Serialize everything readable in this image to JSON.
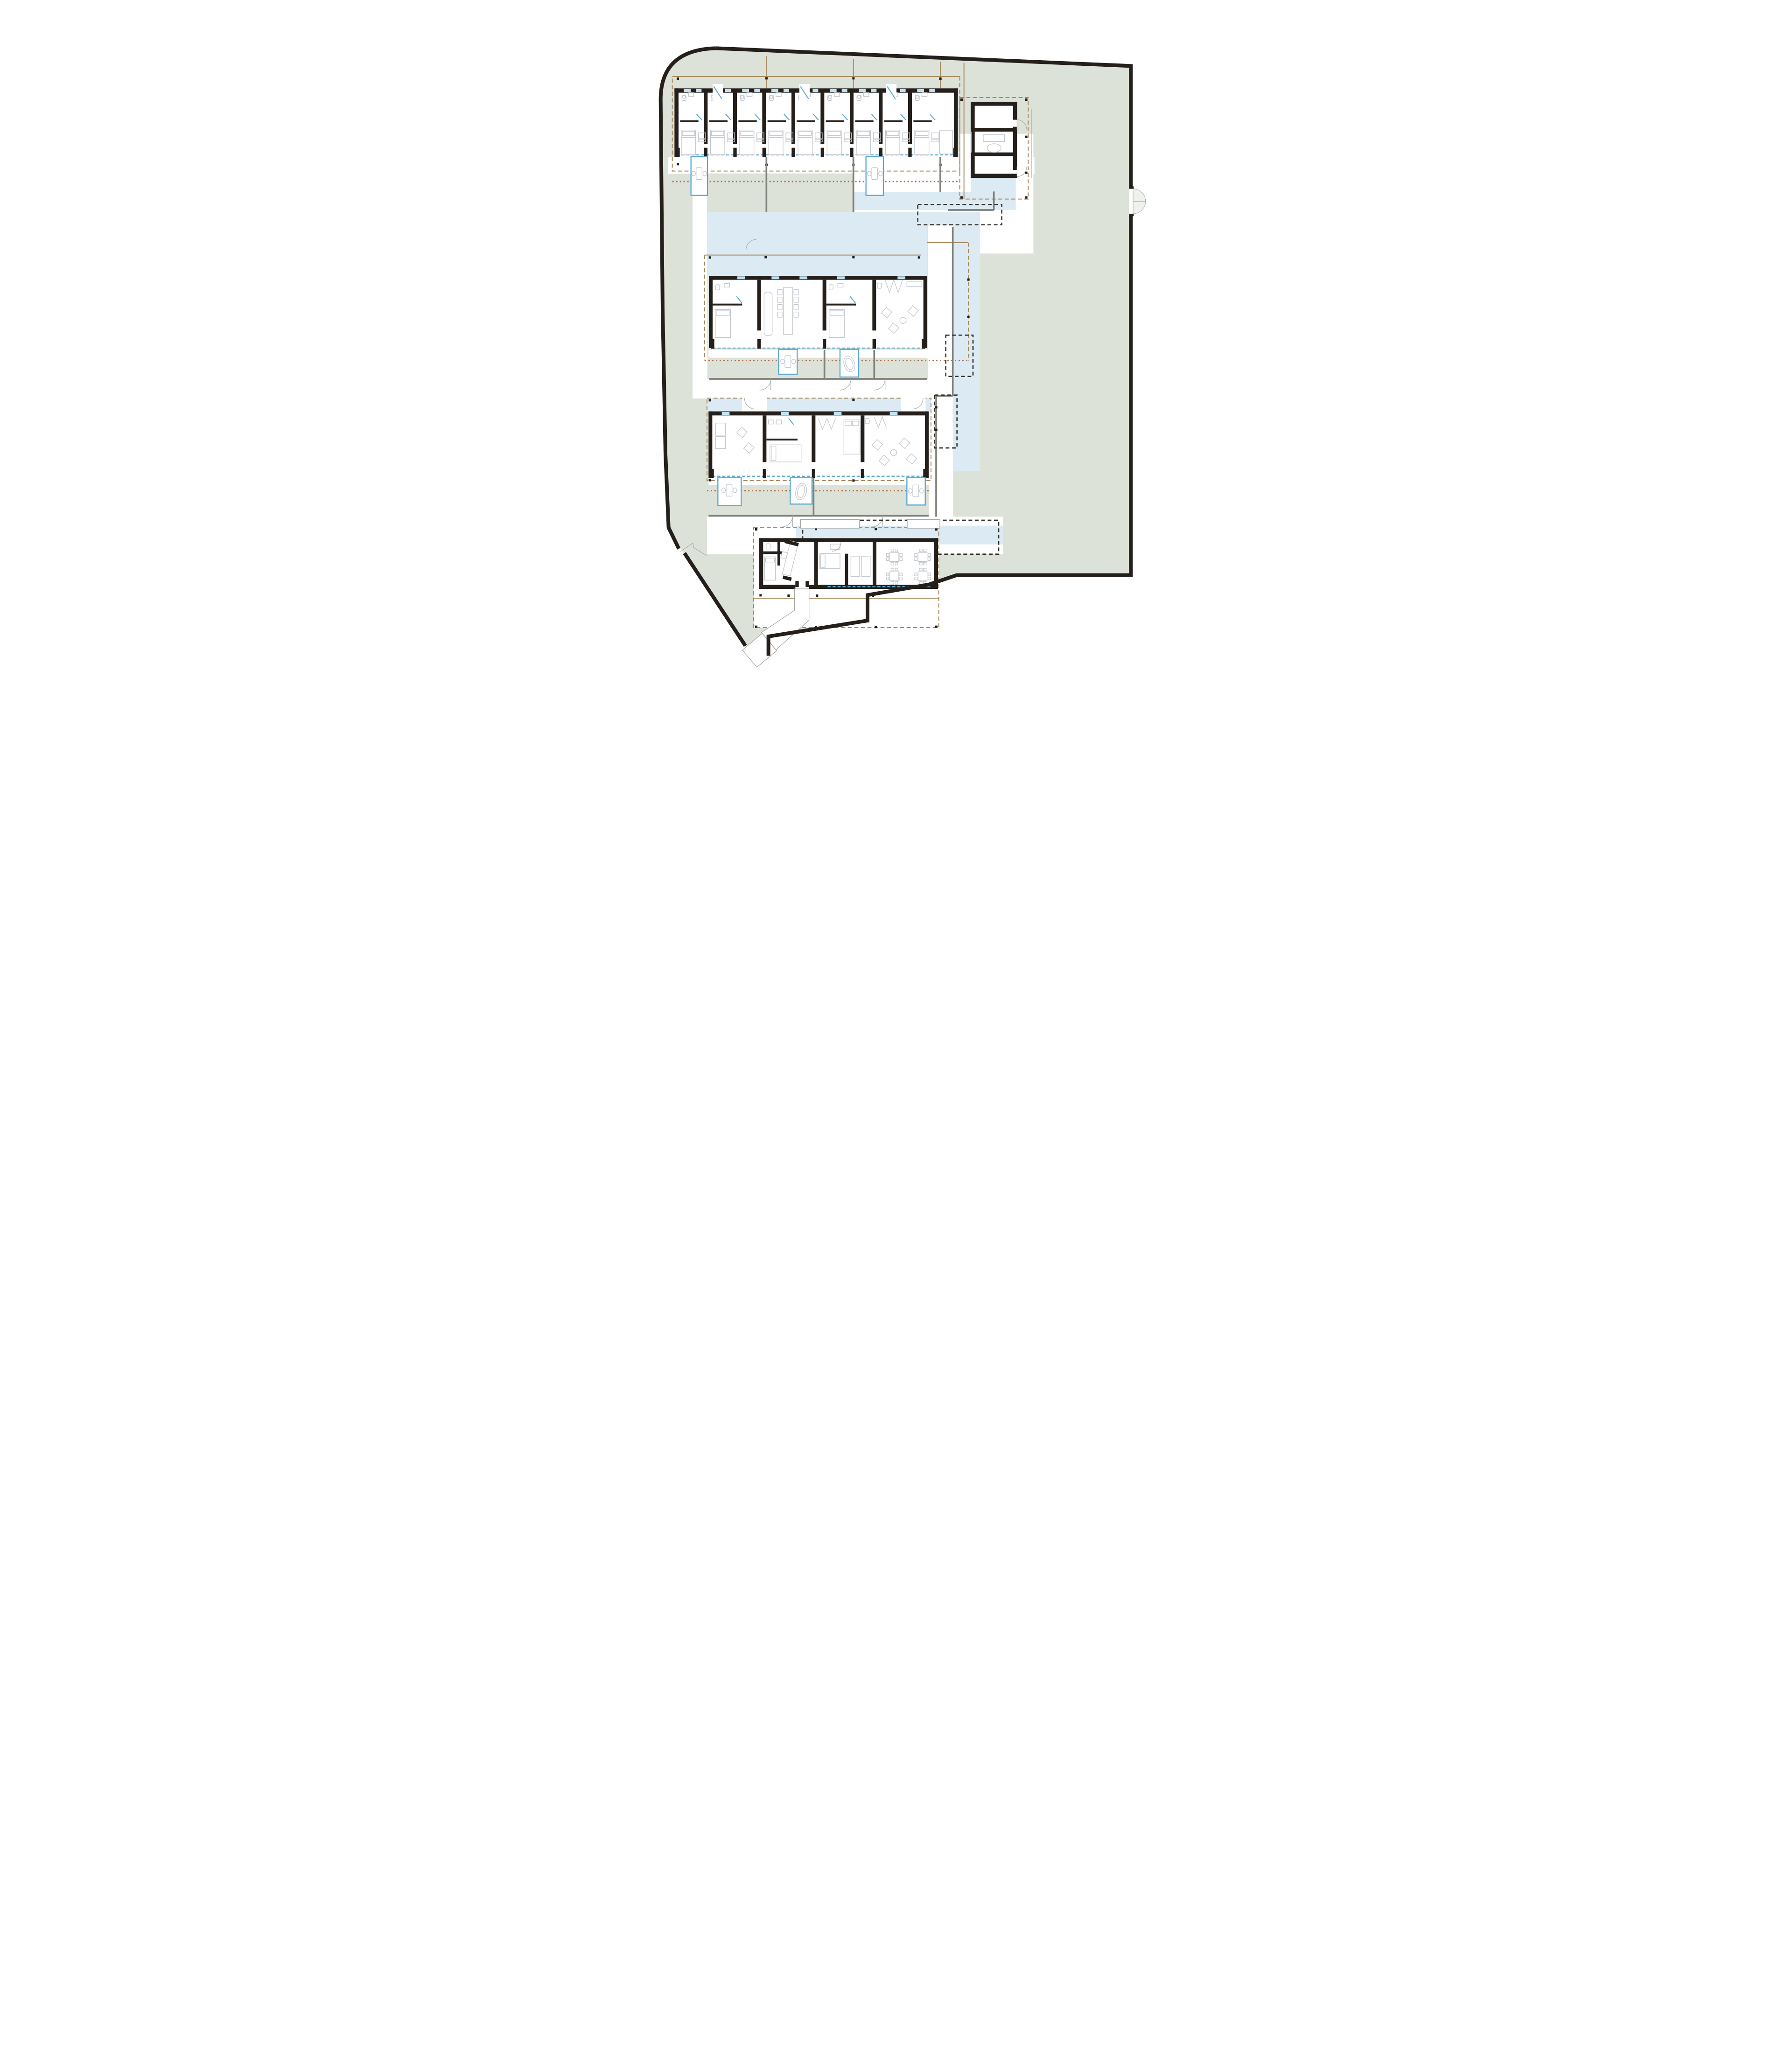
{
  "drawing": {
    "type": "architectural-site-plan",
    "view": "ground-floor-plan",
    "visible_text": "none"
  },
  "palette": {
    "ink": "#241f1b",
    "sage": "#dde2d8",
    "water": "#dceaf3",
    "tan": "#a78c60",
    "rust": "#b3714e",
    "gwall": "#7f817c",
    "accent": "#58a9d0",
    "window": "#bfe0ee",
    "furn": "#c3c8cd",
    "arc": "#a9ada7",
    "thin": "#9b9e99",
    "dash": "#35302b",
    "background": "#ffffff"
  },
  "site": {
    "boundary": "irregular walled plot, rounded north-west corner, gate notch on east wall, stepped south edge, service gate on south-west diagonal",
    "ground": "sage",
    "water_features": "linear reflecting pools weaving between buildings",
    "roof_overhangs": "tan dashed rectangles with column ticks",
    "pergolas": "black dashed rectangles",
    "buildings": [
      {
        "id": "north-guest-wing",
        "rooms": 9,
        "terraces": 2
      },
      {
        "id": "spa-annex",
        "rooms": 3
      },
      {
        "id": "central-guest-wing",
        "units": 4
      },
      {
        "id": "south-guest-wing",
        "units": 4
      },
      {
        "id": "entry-pavilion",
        "zones": [
          "kitchen",
          "guest-rooms",
          "dining"
        ],
        "dining_tables": 4
      }
    ],
    "access": {
      "east_gate": "double-leaf swing gate",
      "south_west_gate": "break in wall with ramp",
      "ramp": "angled entry ramp to pavilion"
    }
  }
}
